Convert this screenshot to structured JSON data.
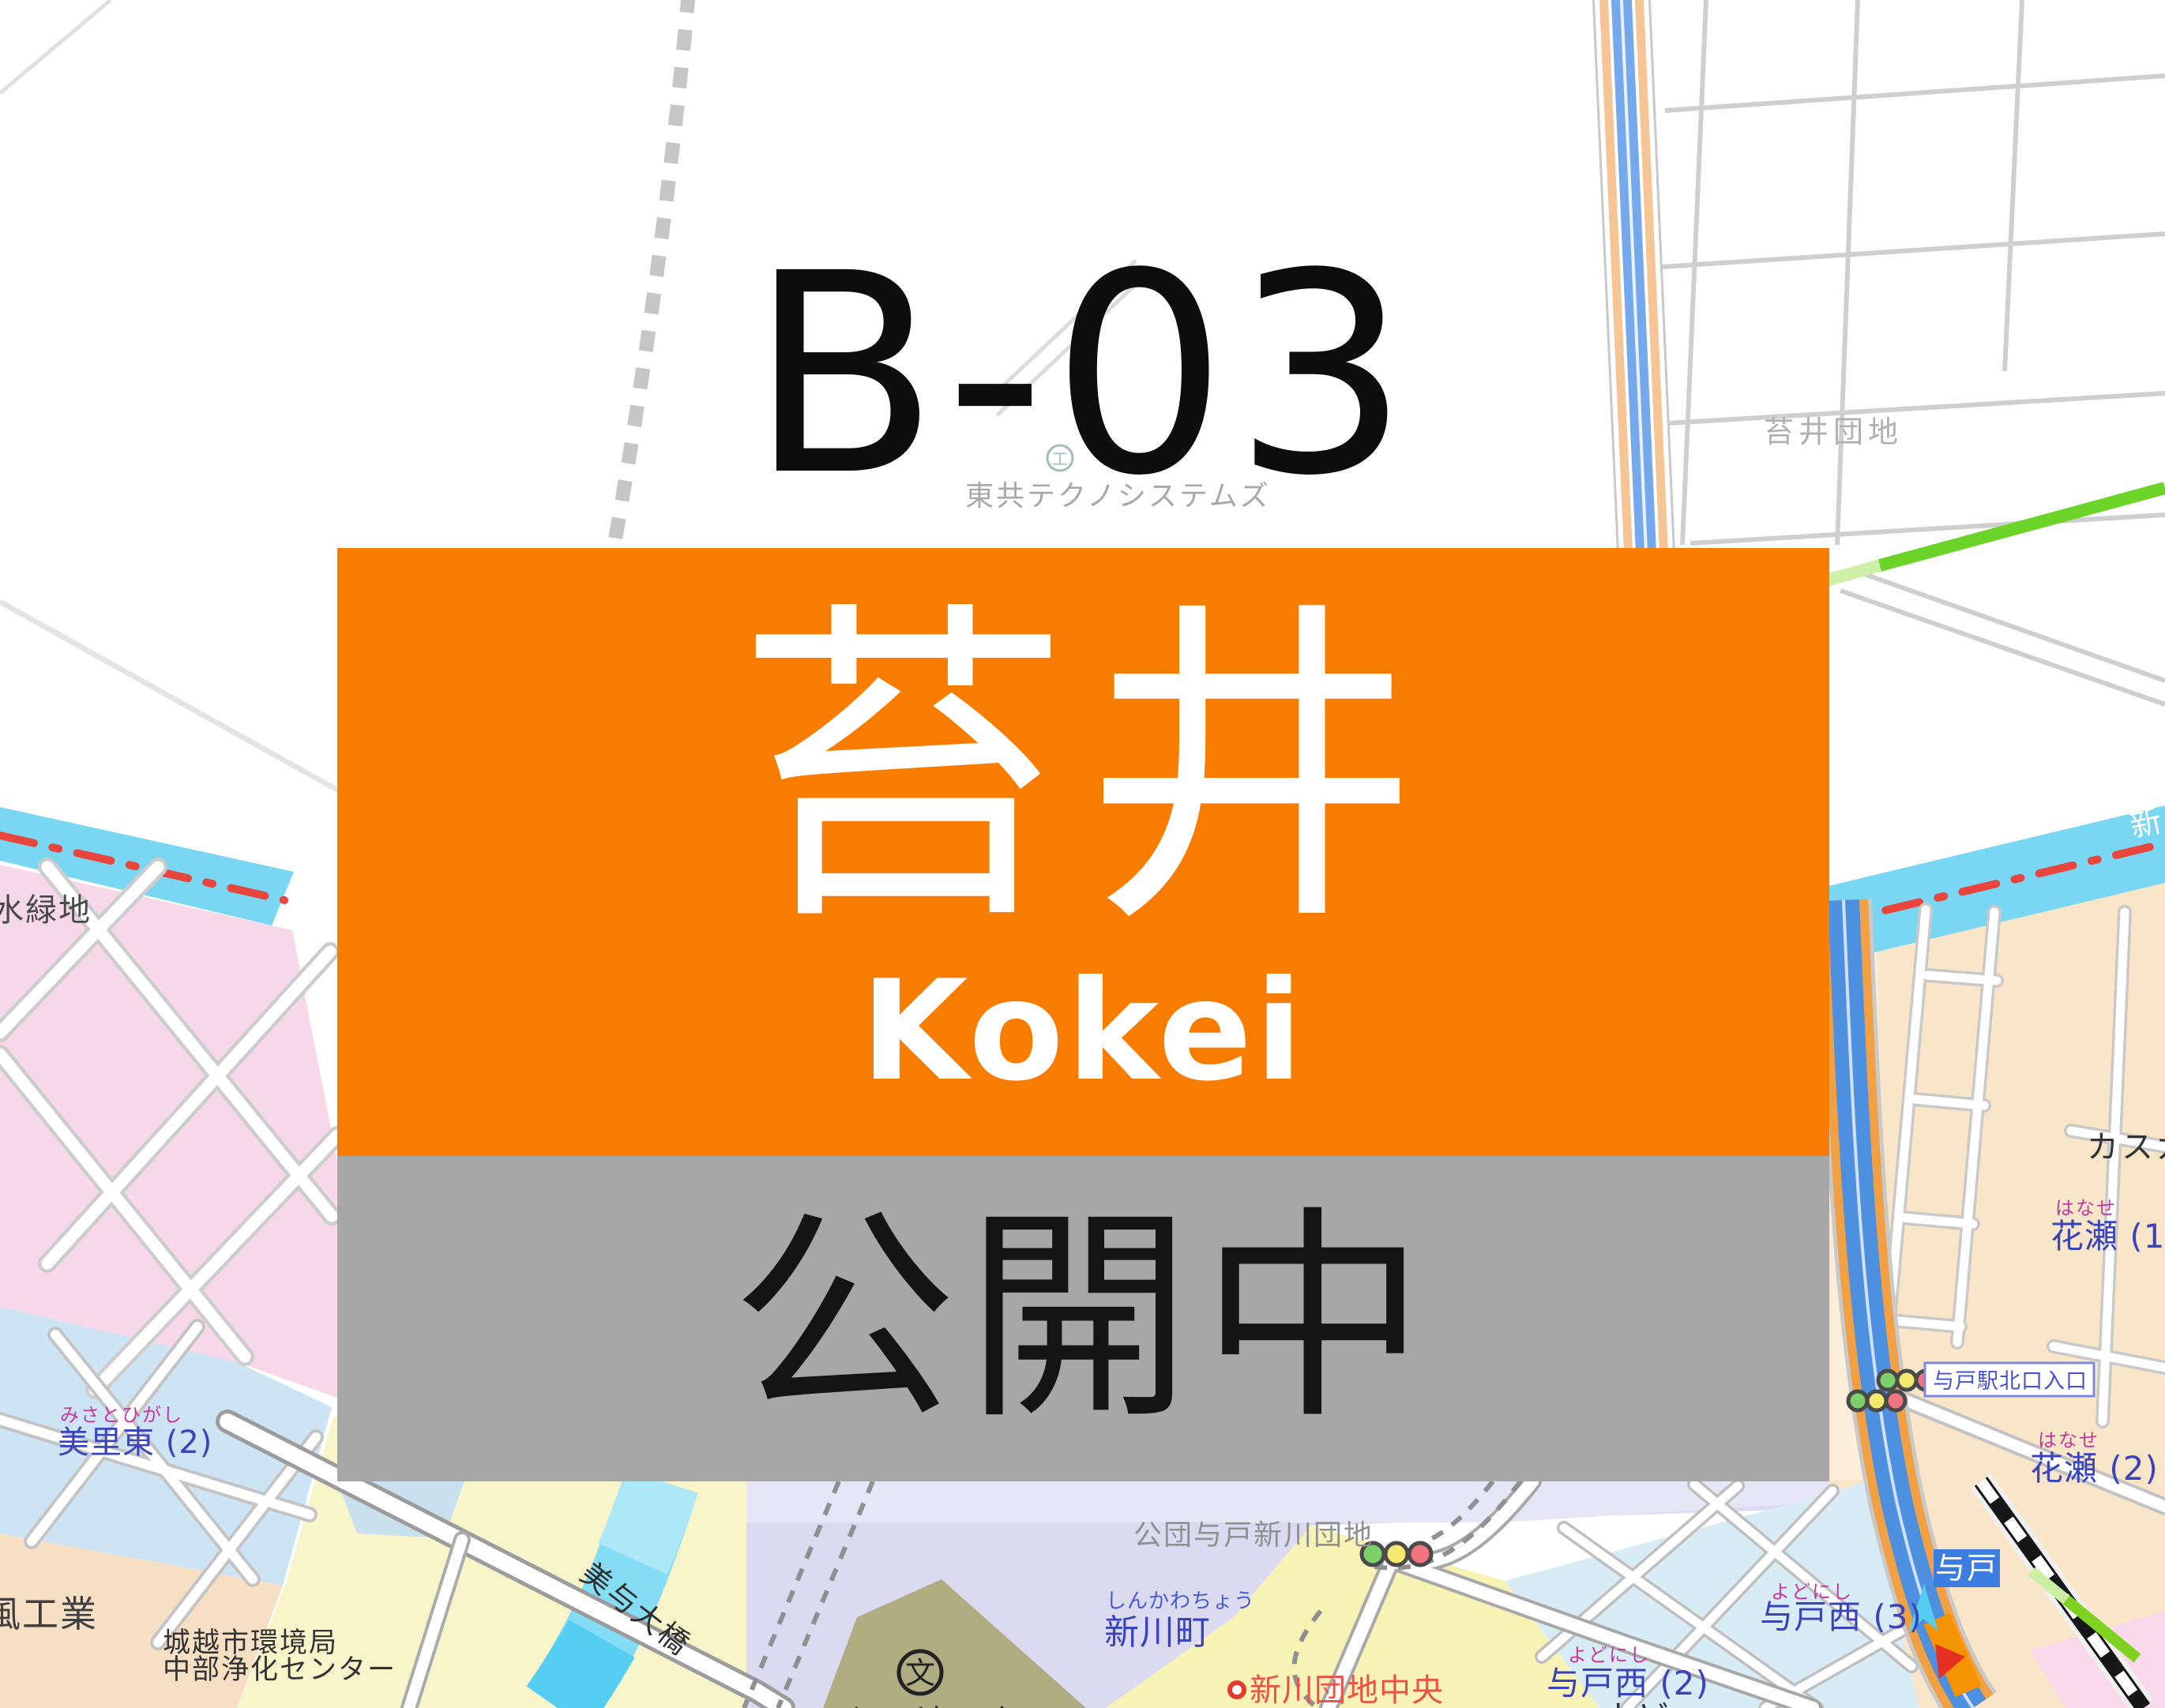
{
  "sign": {
    "line_code": "B-03",
    "station_name_ja": "苔井",
    "station_name_romaji": "Kokei",
    "status_text": "公開中",
    "colors": {
      "banner_orange": "#F87C00",
      "banner_gray": "#A7A7A7",
      "text_white": "#FFFFFF",
      "text_black": "#141414"
    }
  },
  "map": {
    "area_labels": {
      "tokyo_techno": "東共テクノシステムズ",
      "kokei_danchi": "苔井団地",
      "mizu_ryokuchi": "水緑地",
      "misato_furigana": "みさとひがし",
      "misato": "美里東 (2)",
      "kaze_kogyo": "風工業",
      "env_bureau": "城越市環境局",
      "purification_center": "中部浄化センター",
      "miyo_bridge": "美与大橋",
      "kodan_danchi": "公団与戸新川団地",
      "shinkawacho_furigana": "しんかわちょう",
      "shinkawacho": "新川町",
      "yodo_seifu_high": "与戸清風高",
      "shinkawa_danchi_chuo": "新川団地中央",
      "yodonishi3_furigana": "よどにし",
      "yodonishi3": "与戸西 (3)",
      "yodonishi2_furigana": "よどにし",
      "yodonishi2": "与戸西 (2)",
      "hanase1_furigana": "はなせ",
      "hanase1": "花瀬 (1)",
      "hanase2_furigana": "はなせ",
      "hanase2": "花瀬 (2)",
      "kasuga": "カスガヒ",
      "yodo_sta_north": "与戸駅北口入口",
      "yodo_station": "与戸",
      "river_name_partial": "新",
      "bottom_edge_partial": "よど"
    },
    "icons": {
      "school_glyph": "文",
      "factory_glyph": "工"
    },
    "colors": {
      "river_cyan": "#79D7F3",
      "boundary_red": "#E8453C",
      "expressway_blue": "#4D90E0",
      "expressway_casing_orange": "#F2A044",
      "route_green": "#6CD429",
      "area_pink": "#F6D8E9",
      "area_lightblue": "#CCE4F4",
      "area_yellow": "#F8F5CB",
      "area_lavender": "#DBDAF1",
      "area_beige": "#F9E6C8",
      "area_olive": "#B1AD82",
      "label_blue": "#3944BC",
      "label_furigana_pink": "#C0399F",
      "label_red": "#EA5149",
      "label_gray": "#9B9B9B",
      "station_badge_blue": "#3D7CE0"
    }
  }
}
